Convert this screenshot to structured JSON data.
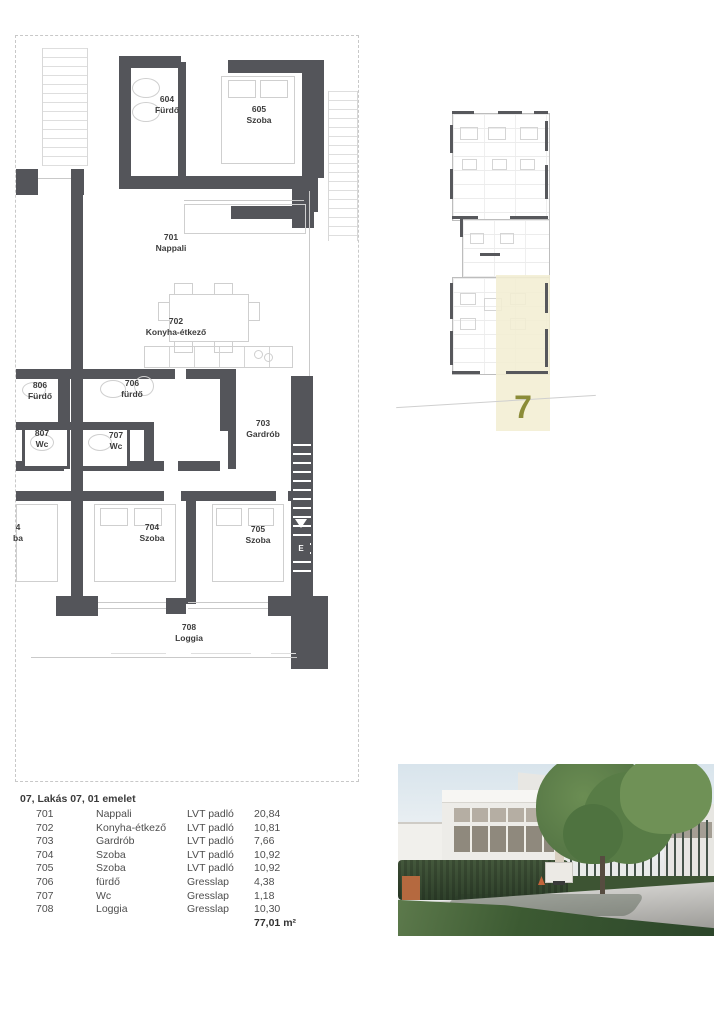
{
  "plan": {
    "rooms": [
      {
        "code": "604",
        "name": "Fürdő"
      },
      {
        "code": "605",
        "name": "Szoba"
      },
      {
        "code": "701",
        "name": "Nappali"
      },
      {
        "code": "702",
        "name": "Konyha-étkező"
      },
      {
        "code": "806",
        "name": "Fürdő"
      },
      {
        "code": "706",
        "name": "fürdő"
      },
      {
        "code": "807",
        "name": "Wc"
      },
      {
        "code": "707",
        "name": "Wc"
      },
      {
        "code": "703",
        "name": "Gardrób"
      },
      {
        "code": "704",
        "name": "Szoba"
      },
      {
        "code": "705",
        "name": "Szoba"
      },
      {
        "code": "708",
        "name": "Loggia"
      },
      {
        "code": "4",
        "name": "ba"
      }
    ],
    "elevator_label": "E"
  },
  "key_plan": {
    "unit_number": "7"
  },
  "area_table": {
    "title": "07, Lakás 07, 01 emelet",
    "rows": [
      {
        "code": "701",
        "name": "Nappali",
        "floor": "LVT padló",
        "area": "20,84"
      },
      {
        "code": "702",
        "name": "Konyha-étkező",
        "floor": "LVT padló",
        "area": "10,81"
      },
      {
        "code": "703",
        "name": "Gardrób",
        "floor": "LVT padló",
        "area": "7,66"
      },
      {
        "code": "704",
        "name": "Szoba",
        "floor": "LVT padló",
        "area": "10,92"
      },
      {
        "code": "705",
        "name": "Szoba",
        "floor": "LVT padló",
        "area": "10,92"
      },
      {
        "code": "706",
        "name": "fürdő",
        "floor": "Gresslap",
        "area": "4,38"
      },
      {
        "code": "707",
        "name": "Wc",
        "floor": "Gresslap",
        "area": "1,18"
      },
      {
        "code": "708",
        "name": "Loggia",
        "floor": "Gresslap",
        "area": "10,30"
      }
    ],
    "total": "77,01 m²"
  },
  "colors": {
    "wall": "#54555a",
    "key_highlight": "#f3eed3",
    "unit_number": "#8b8c38"
  }
}
